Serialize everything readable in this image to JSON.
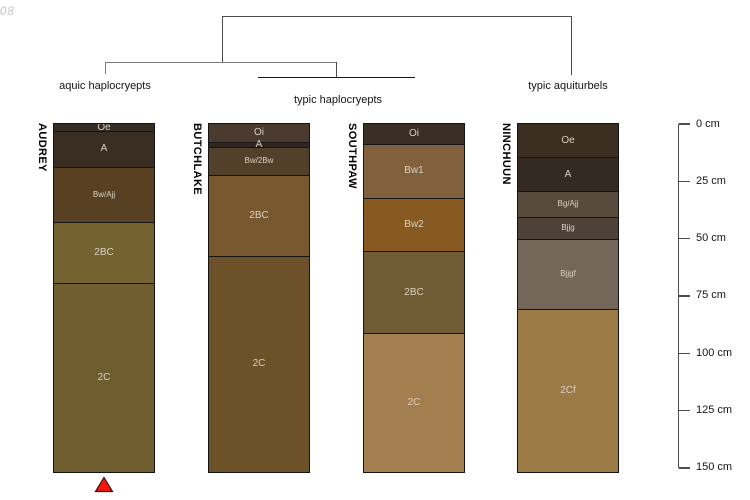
{
  "watermark": "-08",
  "chart_data": {
    "type": "bar",
    "subtype": "soil-profile-sketches-with-dendrogram",
    "orientation": "vertical-depth-columns",
    "depth_axis": {
      "unit": "cm",
      "tick_values": [
        0,
        25,
        50,
        75,
        100,
        125,
        150
      ],
      "tick_labels": [
        "0 cm",
        "25 cm",
        "50 cm",
        "75 cm",
        "100 cm",
        "125 cm",
        "150 cm"
      ],
      "max_depth_cm": 152.5,
      "position": "right"
    },
    "dendrogram_groups": [
      {
        "label": "aquic haplocryepts",
        "profiles": [
          "AUDREY"
        ]
      },
      {
        "label": "typic haplocryepts",
        "profiles": [
          "BUTCHLAKE",
          "SOUTHPAW"
        ]
      },
      {
        "label": "typic aquiturbels",
        "profiles": [
          "NINCHUUN"
        ]
      }
    ],
    "profiles": [
      {
        "name": "AUDREY",
        "group": "aquic haplocryepts",
        "horizons": [
          {
            "label": "Oe",
            "top_cm": 0,
            "bottom_cm": 3.5,
            "color": "#332d26",
            "small": false
          },
          {
            "label": "A",
            "top_cm": 3.5,
            "bottom_cm": 19,
            "color": "#3a2d22",
            "small": false
          },
          {
            "label": "Bw/Ajj",
            "top_cm": 19,
            "bottom_cm": 43,
            "color": "#584023",
            "small": true
          },
          {
            "label": "2BC",
            "top_cm": 43,
            "bottom_cm": 70,
            "color": "#756231",
            "small": false
          },
          {
            "label": "2C",
            "top_cm": 70,
            "bottom_cm": 152.5,
            "color": "#6f5c2f",
            "small": false
          }
        ]
      },
      {
        "name": "BUTCHLAKE",
        "group": "typic haplocryepts",
        "horizons": [
          {
            "label": "Oi",
            "top_cm": 0,
            "bottom_cm": 8.5,
            "color": "#4a3b2e",
            "small": false
          },
          {
            "label": "A",
            "top_cm": 8.5,
            "bottom_cm": 10.5,
            "color": "#2e2722",
            "small": false
          },
          {
            "label": "Bw/2Bw",
            "top_cm": 10.5,
            "bottom_cm": 22.5,
            "color": "#53402a",
            "small": true
          },
          {
            "label": "2BC",
            "top_cm": 22.5,
            "bottom_cm": 58,
            "color": "#77582f",
            "small": false
          },
          {
            "label": "2C",
            "top_cm": 58,
            "bottom_cm": 152.5,
            "color": "#6d5129",
            "small": false
          }
        ]
      },
      {
        "name": "SOUTHPAW",
        "group": "typic haplocryepts",
        "horizons": [
          {
            "label": "Oi",
            "top_cm": 0,
            "bottom_cm": 9,
            "color": "#3a2f25",
            "small": false
          },
          {
            "label": "Bw1",
            "top_cm": 9,
            "bottom_cm": 32.5,
            "color": "#81603e",
            "small": false
          },
          {
            "label": "Bw2",
            "top_cm": 32.5,
            "bottom_cm": 56,
            "color": "#875a21",
            "small": false
          },
          {
            "label": "2BC",
            "top_cm": 56,
            "bottom_cm": 91.5,
            "color": "#6f5b34",
            "small": false
          },
          {
            "label": "2C",
            "top_cm": 91.5,
            "bottom_cm": 152.5,
            "color": "#a37e4f",
            "small": false
          }
        ]
      },
      {
        "name": "NINCHUUN",
        "group": "typic aquiturbels",
        "horizons": [
          {
            "label": "Oe",
            "top_cm": 0,
            "bottom_cm": 15,
            "color": "#3c2e21",
            "small": false
          },
          {
            "label": "A",
            "top_cm": 15,
            "bottom_cm": 29.5,
            "color": "#332a24",
            "small": false
          },
          {
            "label": "Bg/Ajj",
            "top_cm": 29.5,
            "bottom_cm": 41,
            "color": "#594b3b",
            "small": true
          },
          {
            "label": "Bjjg",
            "top_cm": 41,
            "bottom_cm": 50.5,
            "color": "#4e4137",
            "small": true
          },
          {
            "label": "Bjjgf",
            "top_cm": 50.5,
            "bottom_cm": 81,
            "color": "#746658",
            "small": true
          },
          {
            "label": "2Cf",
            "top_cm": 81,
            "bottom_cm": 152.5,
            "color": "#9c7a45",
            "small": false
          }
        ]
      }
    ],
    "annotation_marker": {
      "shape": "filled-triangle-up",
      "color": "#f2190f",
      "below_profile": "AUDREY"
    }
  }
}
